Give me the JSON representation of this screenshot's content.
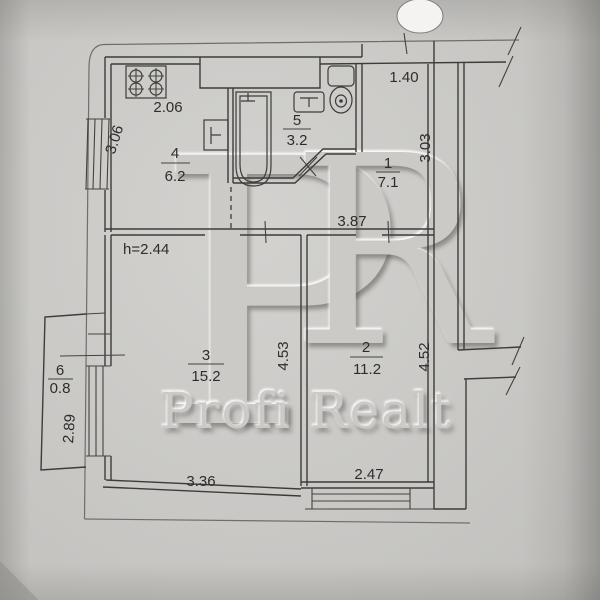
{
  "watermark": {
    "letter_p": "P",
    "letter_r": "R",
    "brand": "Profi Realt"
  },
  "labels": {
    "ceiling_height": "h=2.44"
  },
  "rooms": [
    {
      "number": "1",
      "area": "7.1"
    },
    {
      "number": "2",
      "area": "11.2"
    },
    {
      "number": "3",
      "area": "15.2"
    },
    {
      "number": "4",
      "area": "6.2"
    },
    {
      "number": "5",
      "area": "3.2"
    },
    {
      "number": "6",
      "area": "0.8"
    }
  ],
  "dimensions": {
    "wc_width": "1.40",
    "kitchen_width": "2.06",
    "kitchen_depth": "3.06",
    "hall_width": "3.87",
    "hall_depth": "3.03",
    "room3_width": "3.36",
    "room3_depth": "4.53",
    "room2_width": "2.47",
    "room2_depth": "4.52",
    "balcony_depth": "2.89"
  },
  "fixtures": [
    "stove-icon",
    "bathtub-icon",
    "sink-icon",
    "washbasin-icon",
    "toilet-icon"
  ],
  "colors": {
    "paper": "#c9c8c5",
    "line": "#3d3c3a",
    "text": "#2e2d2b",
    "hole_punch": "#f4f3f1"
  }
}
